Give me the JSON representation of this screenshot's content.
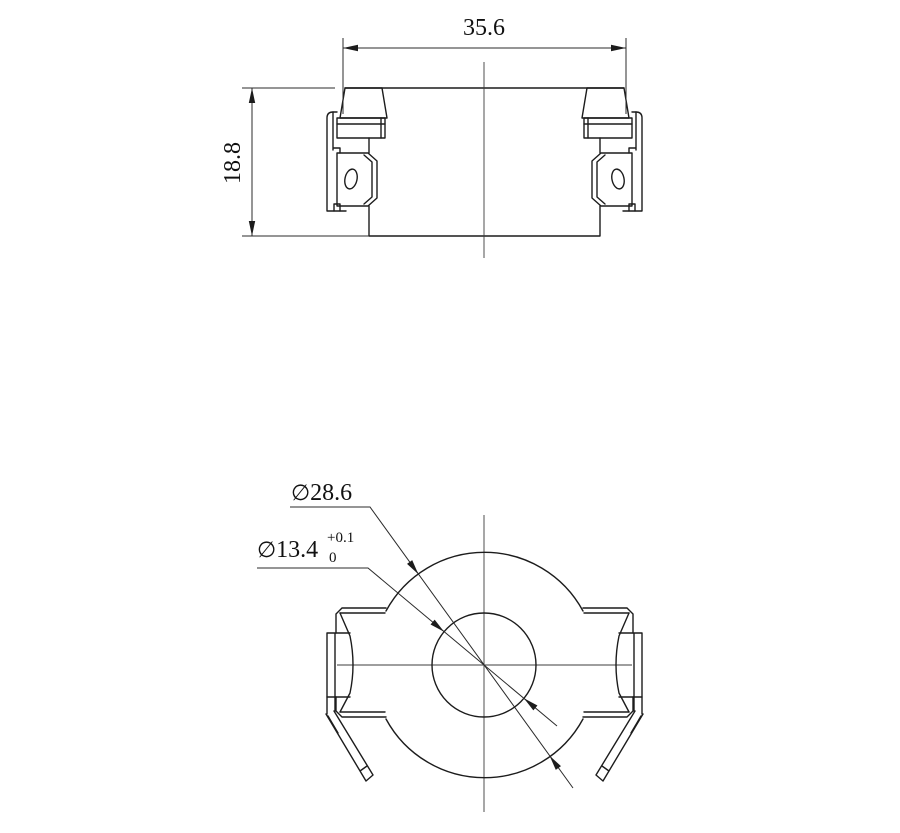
{
  "dims": {
    "width": "35.6",
    "height": "18.8",
    "outer_symbol": "∅",
    "outer_value": "28.6",
    "inner_symbol": "∅",
    "inner_value": "13.4",
    "inner_tol_upper": "+0.1",
    "inner_tol_lower": "0"
  },
  "colors": {
    "line": "#1c1c1c",
    "dimension_line": "#2b2b2b",
    "background": "#ffffff"
  }
}
